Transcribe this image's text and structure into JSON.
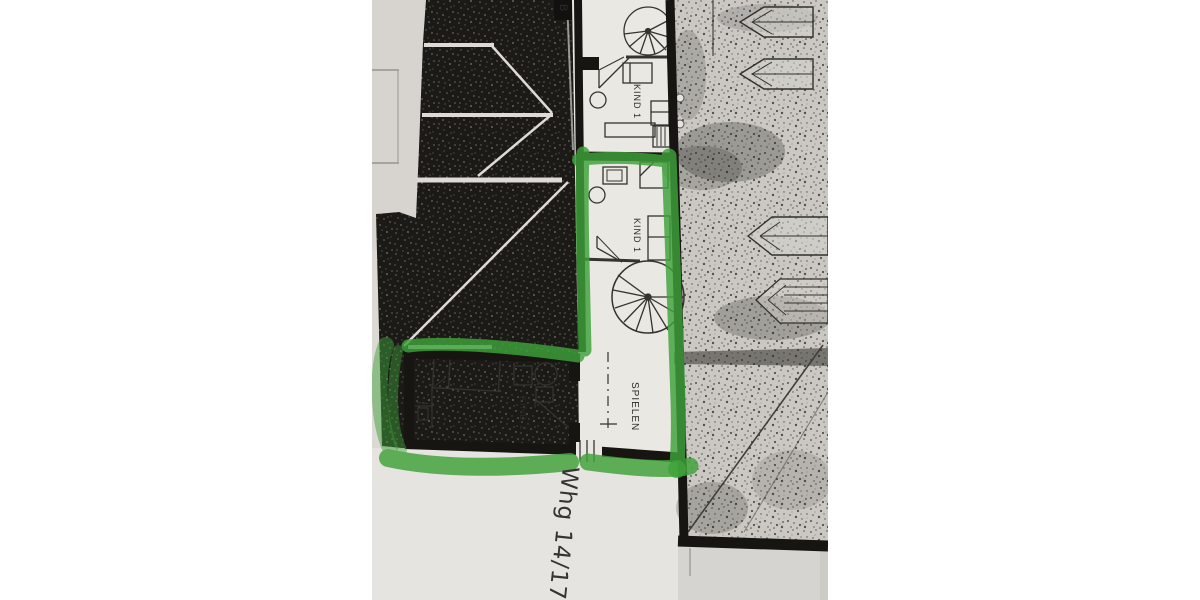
{
  "plan": {
    "corner_mark": "B",
    "rooms": {
      "top": "KIND 1",
      "middle": "KIND 1",
      "kind2": "KIND 2",
      "play": "SPIELEN"
    },
    "apartment_label": "Whg 14/17",
    "colors": {
      "highlighter": "#3fa23a",
      "ink": "#1b1a17",
      "paper": "#dcd9d5",
      "paper_light": "#eae8e3",
      "site": "#cbc8c3",
      "roof_dark": "#1b1a17"
    }
  }
}
